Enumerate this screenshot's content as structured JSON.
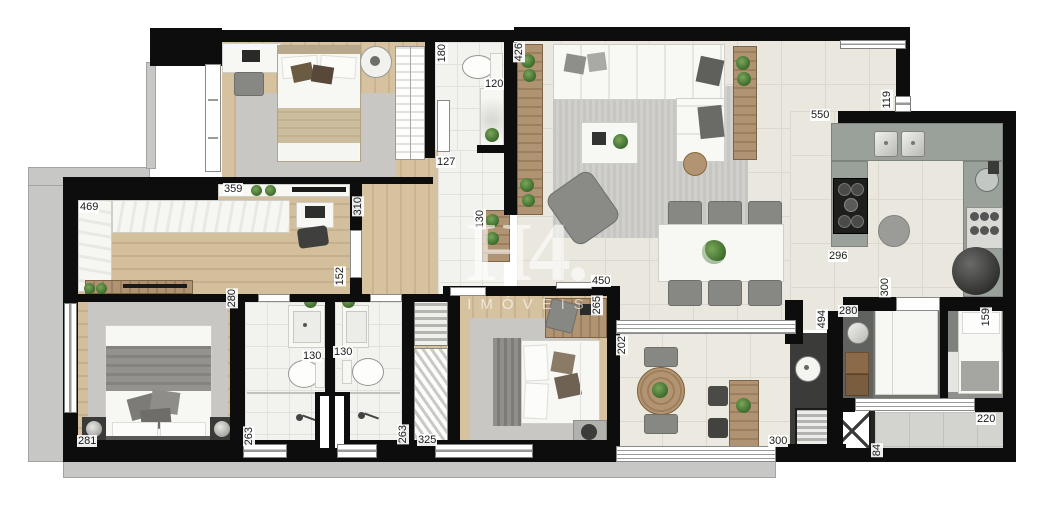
{
  "watermark": {
    "logo": "H4.",
    "subtitle": "IMÓVEIS"
  },
  "palette": {
    "wall": "#0d0d0d",
    "slab_gray": "#c7c7c5",
    "tile_floor": "#eae7df",
    "wood_floor": "#d4bf9d",
    "kitchen_counter": "#9aa09a",
    "dark_counter": "#3b3b39",
    "plant_green": "#41702f",
    "rug_gray": "#c8c7c4"
  },
  "measurements": [
    {
      "value": "180",
      "x": 436,
      "y": 43,
      "vertical": true
    },
    {
      "value": "120",
      "x": 484,
      "y": 78,
      "vertical": false
    },
    {
      "value": "426",
      "x": 513,
      "y": 42,
      "vertical": true
    },
    {
      "value": "550",
      "x": 810,
      "y": 109,
      "vertical": false
    },
    {
      "value": "119",
      "x": 881,
      "y": 90,
      "vertical": true
    },
    {
      "value": "127",
      "x": 436,
      "y": 156,
      "vertical": false
    },
    {
      "value": "359",
      "x": 223,
      "y": 183,
      "vertical": false
    },
    {
      "value": "469",
      "x": 79,
      "y": 201,
      "vertical": false
    },
    {
      "value": "310",
      "x": 352,
      "y": 196,
      "vertical": true
    },
    {
      "value": "130",
      "x": 474,
      "y": 209,
      "vertical": true
    },
    {
      "value": "152",
      "x": 334,
      "y": 266,
      "vertical": true
    },
    {
      "value": "280",
      "x": 226,
      "y": 288,
      "vertical": true
    },
    {
      "value": "450",
      "x": 591,
      "y": 275,
      "vertical": false
    },
    {
      "value": "265",
      "x": 591,
      "y": 295,
      "vertical": true
    },
    {
      "value": "296",
      "x": 828,
      "y": 250,
      "vertical": false
    },
    {
      "value": "300",
      "x": 879,
      "y": 277,
      "vertical": true
    },
    {
      "value": "202",
      "x": 616,
      "y": 335,
      "vertical": true
    },
    {
      "value": "494",
      "x": 816,
      "y": 309,
      "vertical": true
    },
    {
      "value": "280",
      "x": 838,
      "y": 305,
      "vertical": false
    },
    {
      "value": "159",
      "x": 980,
      "y": 307,
      "vertical": true
    },
    {
      "value": "130",
      "x": 302,
      "y": 350,
      "vertical": false
    },
    {
      "value": "130",
      "x": 333,
      "y": 346,
      "vertical": false
    },
    {
      "value": "300",
      "x": 768,
      "y": 435,
      "vertical": false
    },
    {
      "value": "220",
      "x": 976,
      "y": 413,
      "vertical": false
    },
    {
      "value": "84",
      "x": 871,
      "y": 443,
      "vertical": true
    },
    {
      "value": "281",
      "x": 77,
      "y": 435,
      "vertical": false
    },
    {
      "value": "263",
      "x": 243,
      "y": 426,
      "vertical": true
    },
    {
      "value": "263",
      "x": 397,
      "y": 424,
      "vertical": true
    },
    {
      "value": "325",
      "x": 417,
      "y": 434,
      "vertical": false
    }
  ]
}
